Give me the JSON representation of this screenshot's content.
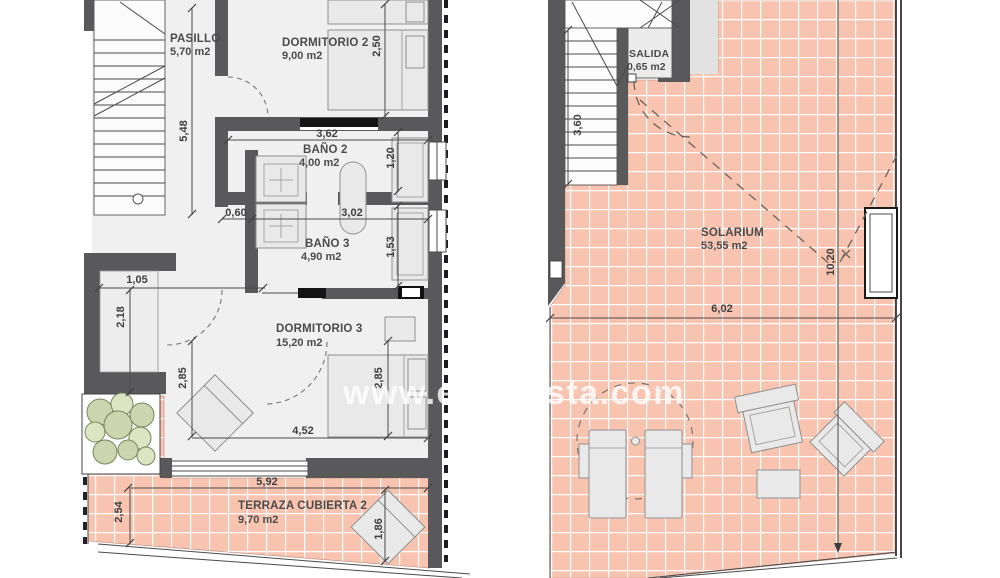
{
  "watermark": {
    "left": "www.es",
    "right": "sta.com"
  },
  "colors": {
    "tile": "#f8c3af",
    "grout": "#ffffff",
    "wall": "#59595b",
    "furniture": "#e9e9e9",
    "text": "#4b4b4d"
  },
  "plans": {
    "first_floor": {
      "rooms": {
        "pasillo": {
          "name": "PASILLO",
          "area": "5,70 m2"
        },
        "dormitorio2": {
          "name": "DORMITORIO 2",
          "area": "9,00 m2"
        },
        "bano2": {
          "name": "BAÑO 2",
          "area": "4,00 m2"
        },
        "bano3": {
          "name": "BAÑO 3",
          "area": "4,90 m2"
        },
        "dormitorio3": {
          "name": "DORMITORIO 3",
          "area": "15,20 m2"
        },
        "terraza": {
          "name": "TERRAZA CUBIERTA 2",
          "area": "9,70 m2"
        }
      },
      "dims": {
        "stair_height": "5,48",
        "dorm2_width": "2,50",
        "dorm2_length": "3,62",
        "bano2_width": "1,20",
        "hall_nook": "0,60",
        "bano_length": "3,02",
        "bano3_width": "1,53",
        "closet_width": "1,05",
        "closet_height": "2,18",
        "dorm3_left": "2,85",
        "dorm3_right": "2,85",
        "dorm3_length": "4,52",
        "terraza_length": "5,92",
        "terraza_width": "2,54",
        "lounger": "1,86"
      }
    },
    "roof": {
      "rooms": {
        "salida": {
          "name": "SALIDA",
          "area": "0,65 m2"
        },
        "solarium": {
          "name": "SOLARIUM",
          "area": "53,55 m2"
        }
      },
      "dims": {
        "stair_height": "3,60",
        "solarium_height": "10,20",
        "solarium_width": "6,02"
      }
    }
  }
}
